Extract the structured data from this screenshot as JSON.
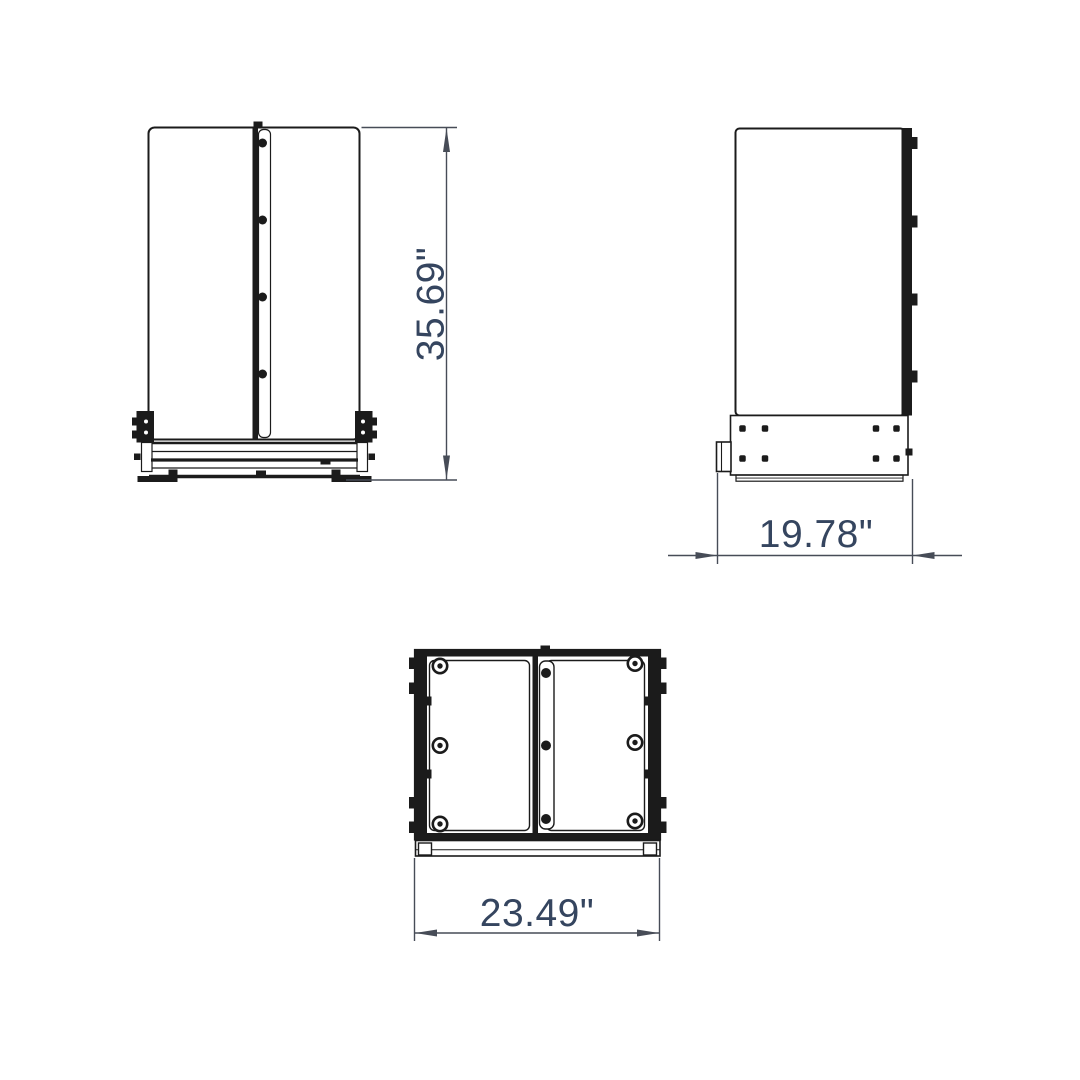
{
  "drawing": {
    "description": "Three-view dimensioned technical drawing of a floor stand fixture",
    "views": {
      "front": {
        "label": "front-view",
        "dimension": {
          "value": "35.69\"",
          "axis": "height"
        }
      },
      "side": {
        "label": "side-view",
        "dimension": {
          "value": "19.78\"",
          "axis": "depth"
        }
      },
      "top": {
        "label": "top-view",
        "dimension": {
          "value": "23.49\"",
          "axis": "width"
        }
      }
    }
  },
  "colors": {
    "background": "#ffffff",
    "part-line": "#1b1b1b",
    "part-fill": "#ffffff",
    "dim-line": "#474c57",
    "dim-text": "#35455f"
  }
}
